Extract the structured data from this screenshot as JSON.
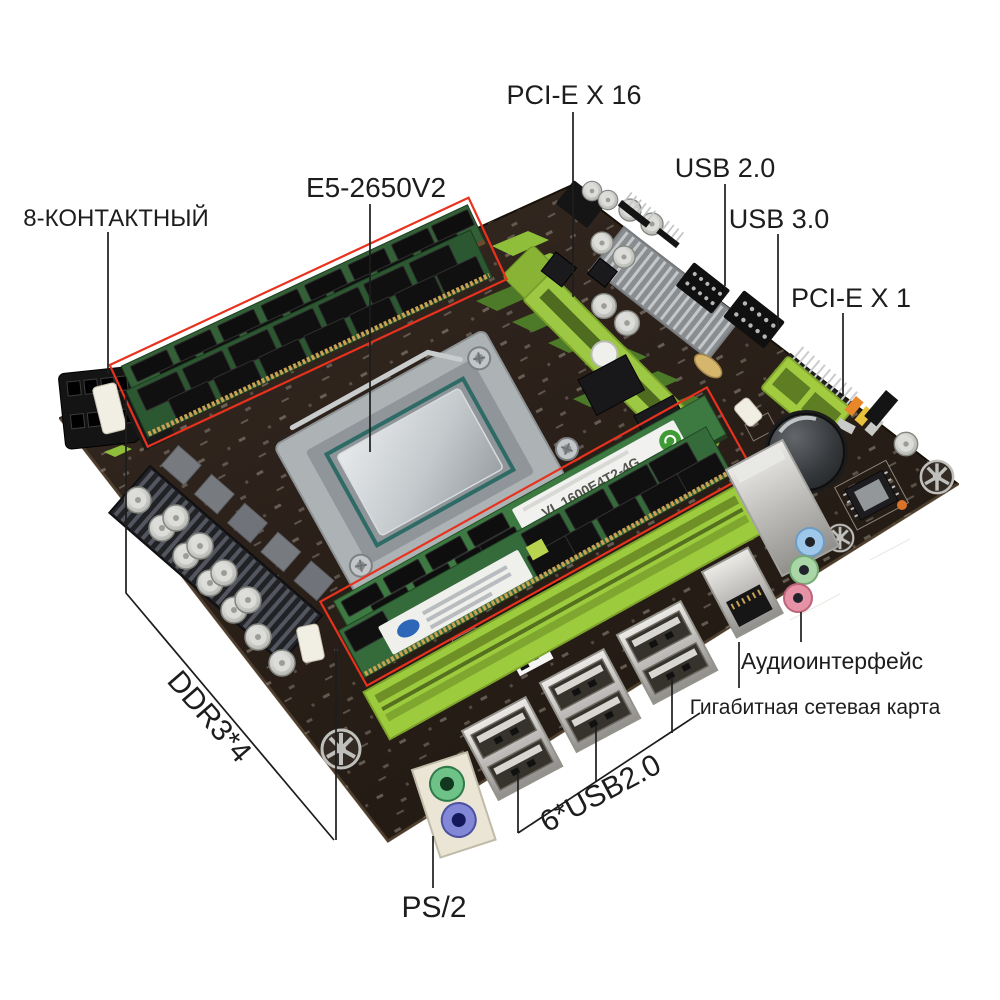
{
  "colors": {
    "background": "#ffffff",
    "pcb": "#2a211a",
    "accent_lime": "#9ccb3d",
    "highlight_box_red": "#e8321e",
    "callout_line": "#1d1d1d",
    "audio_jack_blue": "#9ec7ea",
    "audio_jack_green": "#a9d6a6",
    "audio_jack_pink": "#e591a6",
    "ps2_green": "#6fc287",
    "ps2_purple": "#8287d6"
  },
  "callouts": {
    "pcie_x16": "PCI-E X 16",
    "usb_2_0": "USB 2.0",
    "usb_3_0": "USB 3.0",
    "pcie_x1": "PCI-E X 1",
    "cpu_model": "E5-2650V2",
    "power_8pin": "8-КОНТАКТНЫЙ",
    "ddr3_slots": "DDR3*4",
    "ps2_port": "PS/2",
    "rear_usb": "6*USB2.0",
    "audio_interface": "Аудиоинтерфейс",
    "gigabit_lan": "Гигабитная сетевая карта"
  },
  "board": {
    "ram_sticker_text": "VL 1600E4T2-4G"
  }
}
